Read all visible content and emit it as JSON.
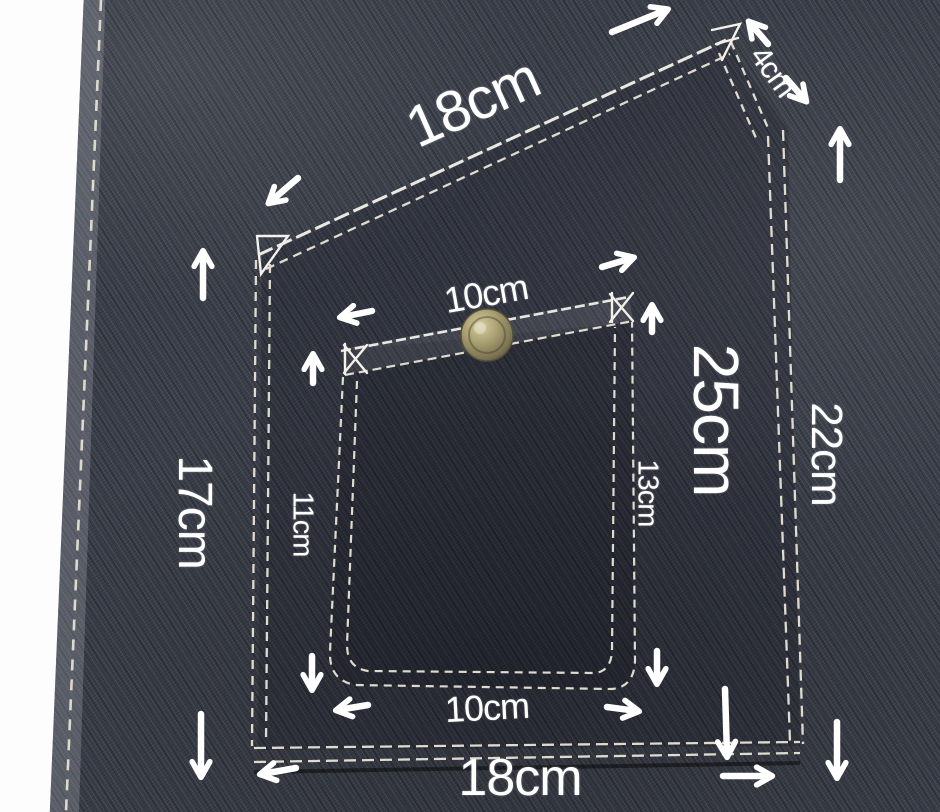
{
  "photo": {
    "subject": "denim-pocket-with-sewing-measurements"
  },
  "labels": {
    "top_width": "18cm",
    "flap_edge": "4cm",
    "opening_width": "10cm",
    "pocket_height": "25cm",
    "right_height": "22cm",
    "inner_right_height": "13cm",
    "left_height": "17cm",
    "inner_left_height": "11cm",
    "inner_bottom_width": "10cm",
    "bottom_width": "18cm"
  },
  "colors": {
    "denim_base": "#363a44",
    "denim_dark": "#2c303a",
    "denim_light": "#4a4f5b",
    "hem_fold": "#6a6e78",
    "stitch_thread": "#e9e4d6",
    "annotation": "#ffffff",
    "button_brass": "#a89e70",
    "background_white": "#fdfdfd"
  }
}
